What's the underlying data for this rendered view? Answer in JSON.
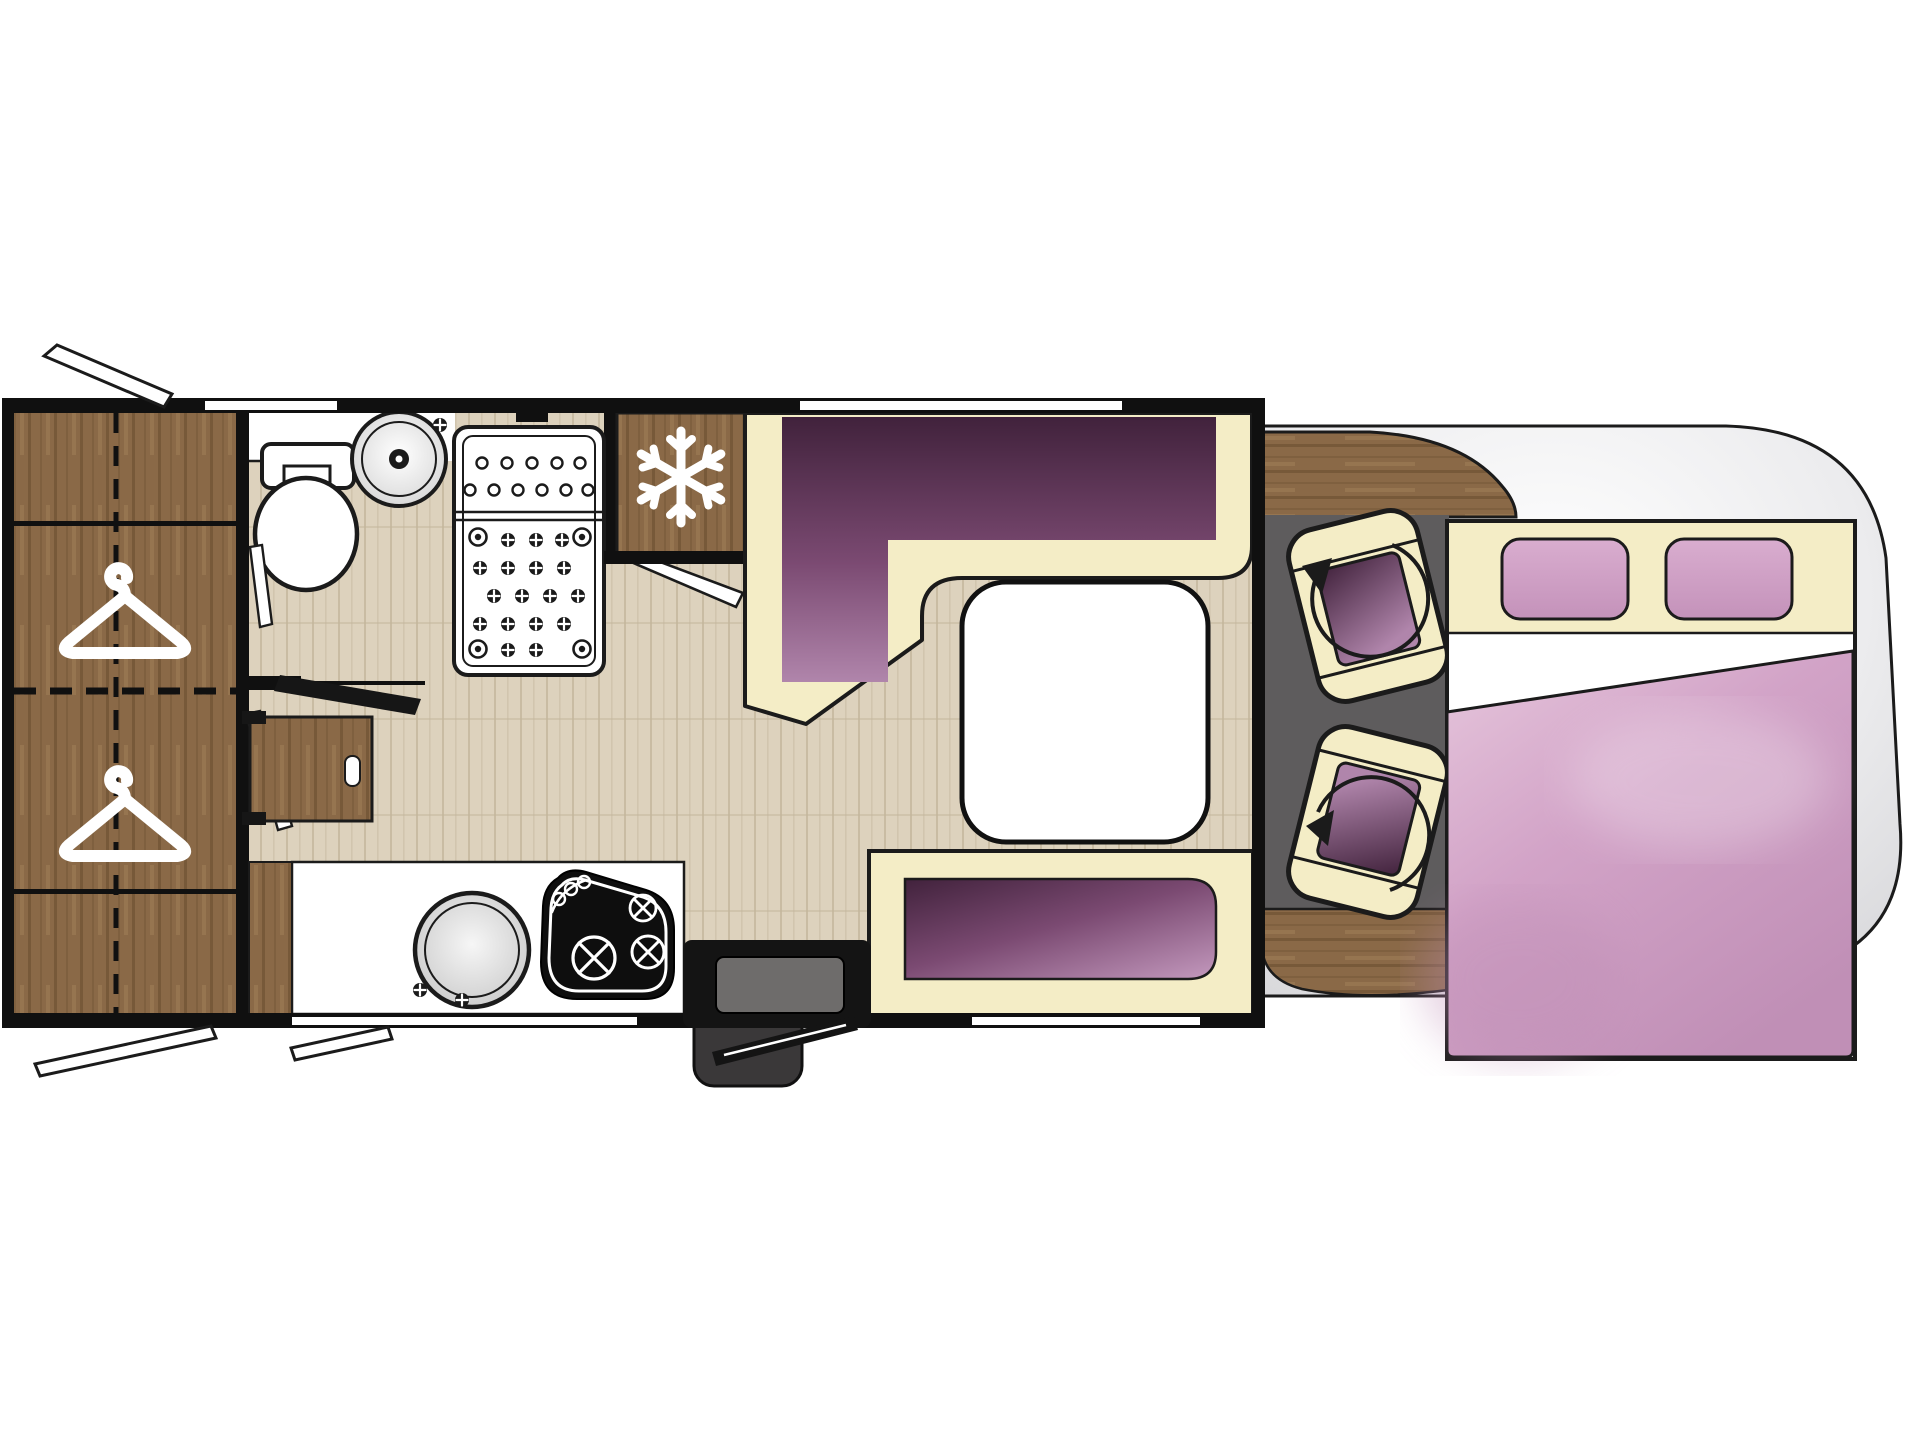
{
  "page": {
    "title": "Motorhome floor plan — top view"
  },
  "colors": {
    "outline": "#1b1b1b",
    "wall": "#101010",
    "white": "#ffffff",
    "cream": "#f4edc6",
    "purple_dark": "#41223c",
    "purple_mid": "#7b4a72",
    "purple_light": "#b085ab",
    "bench_light": "#bd92b7",
    "pillow": "#d9adcf",
    "pillow_deep": "#c492ba",
    "duvet": "#d2a3c7",
    "duvet_light": "#e6c6dc",
    "duvet_deep": "#c08fb6",
    "wood": "#8a6947",
    "wood_dark": "#5f4529",
    "wood_light": "#a8865c",
    "floor": "#ddd2bd",
    "floor_streak": "#c4b69c",
    "cab_floor": "#5e5c5d",
    "silhouette": "#d4d4d7",
    "step_outer": "#3a3839",
    "step_inner": "#6e6c6b",
    "hob": "#0e0e0e"
  },
  "fixtures": {
    "rear_wardrobe": {
      "icon": "hanger-icon",
      "hangers": 2
    },
    "bathroom": {
      "items": [
        "toilet",
        "washbasin",
        "open-door"
      ]
    },
    "shower": {
      "tray": "perforated-two-section"
    },
    "fridge": {
      "icon": "snowflake-icon"
    },
    "lounge": {
      "sofa": "l-shaped-dinette",
      "table": "rounded-square-table",
      "side_bench": "two-seat-bench"
    },
    "kitchen": {
      "items": [
        "round-sink",
        "three-burner-hob"
      ],
      "desk": "fold-out-desk"
    },
    "entry": {
      "items": [
        "double-step",
        "open-entry-door"
      ]
    },
    "cab": {
      "seats": 2,
      "icon": "rotation-arrow-icon",
      "dashboard": "curved-wood"
    },
    "bed": {
      "type": "double-bed-overlay",
      "pillows": 2
    },
    "openings": {
      "top_windows": 2,
      "bottom_windows": 2,
      "service_flaps": 3
    }
  }
}
